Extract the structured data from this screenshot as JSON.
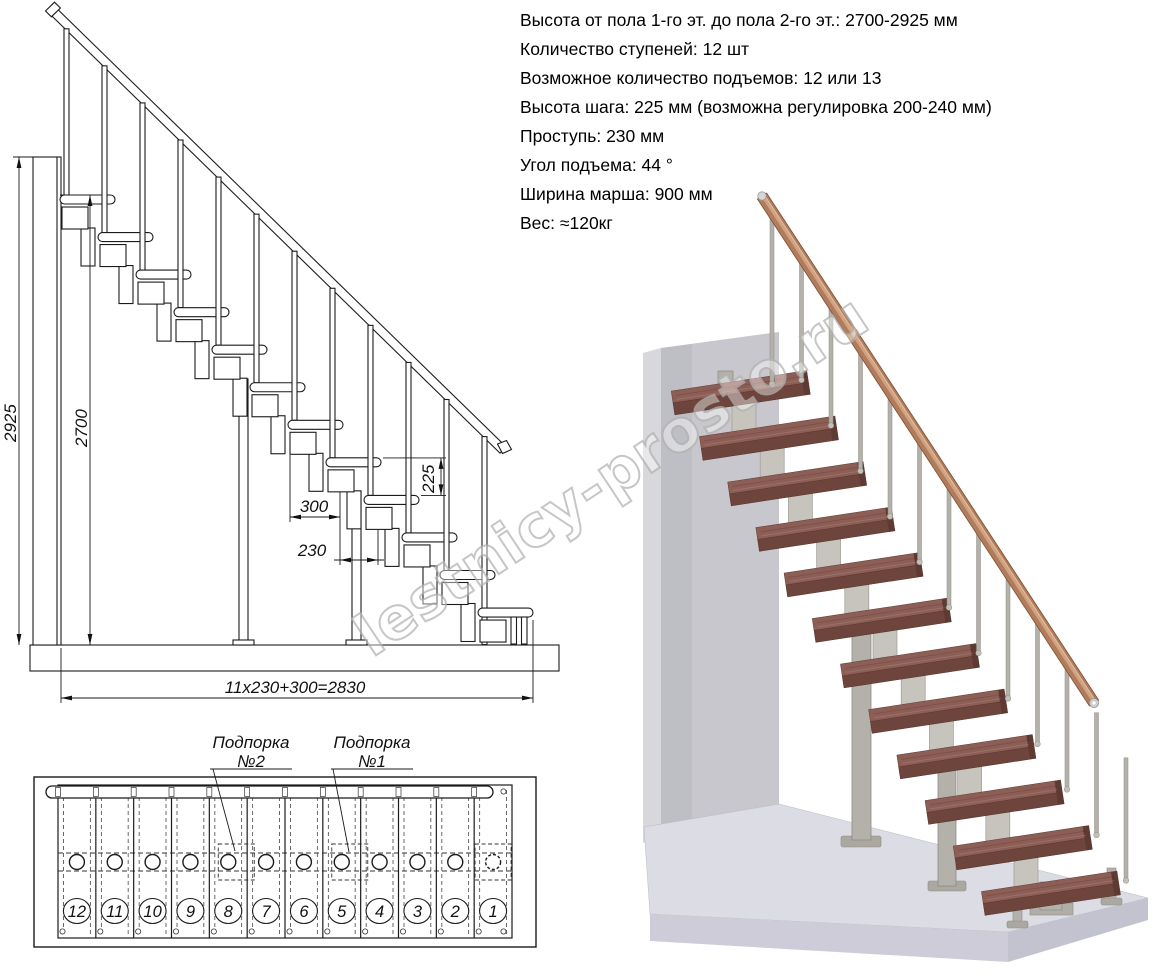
{
  "specs": {
    "lines": [
      "Высота от пола 1-го эт. до пола 2-го эт.: 2700-2925 мм",
      "Количество ступеней: 12 шт",
      "Возможное количество подъемов: 12 или 13",
      "Высота шага: 225 мм (возможна регулировка 200-240 мм)",
      "Проступь: 230 мм",
      "Угол подъема: 44 °",
      "Ширина марша: 900 мм",
      "Вес: ≈120кг"
    ]
  },
  "elevation": {
    "steps_count": 12,
    "dims": {
      "total_height": "2925",
      "height_to_top_tread": "2700",
      "top_step_depth": "300",
      "tread_depth": "230",
      "rise": "225",
      "total_run": "11x230+300=2830"
    }
  },
  "plan": {
    "step_numbers": [
      "12",
      "11",
      "10",
      "9",
      "8",
      "7",
      "6",
      "5",
      "4",
      "3",
      "2",
      "1"
    ],
    "supports": [
      {
        "line1": "Подпорка",
        "line2": "№2",
        "step": "8"
      },
      {
        "line1": "Подпорка",
        "line2": "№1",
        "step": "5"
      }
    ]
  },
  "watermark": "lestnicy-prosto.ru",
  "colors": {
    "line": "#1b1b1b",
    "tread_top": "#8d5e55",
    "tread_front": "#6e453d",
    "tread_side": "#5f3a33",
    "rail_wood": "#b07c5c",
    "rail_light": "#d7a988",
    "metal": "#b3b1a9",
    "metal_dark": "#8e8c84",
    "module_gray": "#c6c4bc",
    "wall_light": "#d8d8dc",
    "wall_mid": "#c7c7cd",
    "wall_shadow": "#b6b6bf",
    "floor_top": "#dcdce5",
    "floor_front": "#cdccd8",
    "floor_side": "#c3c3cf",
    "watermark_gray": "#b3b3b3"
  }
}
